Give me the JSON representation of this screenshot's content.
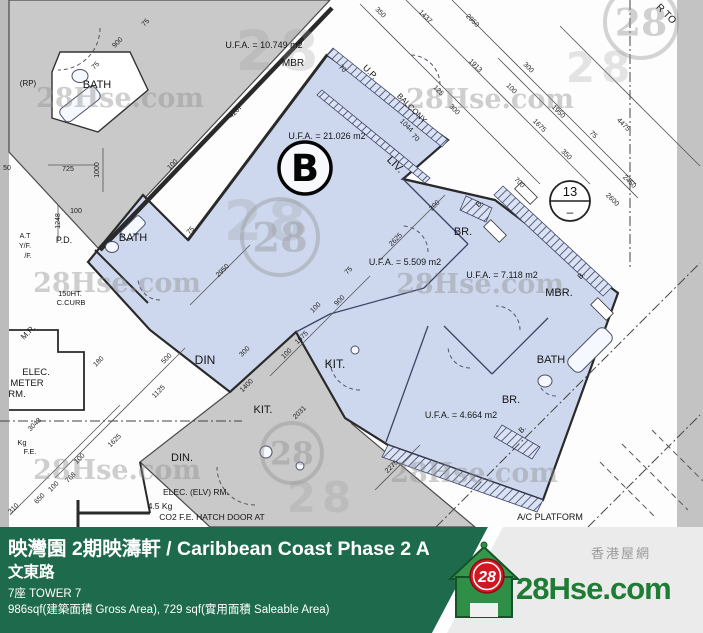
{
  "colors": {
    "footer_green": "#1d6b4c",
    "footer_gray": "#ebebeb",
    "brand_green": "#1e7c35",
    "badge_red": "#d01722",
    "unit_fill": "#cdd8ee",
    "neighbor_fill": "#c9c9c9",
    "edge_strip": "#bcbcbc",
    "line": "#2a2a2a",
    "watermark": "#8f8f8f",
    "plan_bg": "#fdfdfd"
  },
  "plan": {
    "unit_label": "B",
    "grid_bubble": {
      "number": "13",
      "dash": "–"
    },
    "labels": [
      {
        "t": "U.F.A. = 10.749 m2",
        "x": 264,
        "y": 48,
        "s": 9,
        "r": 0
      },
      {
        "t": "MBR",
        "x": 293,
        "y": 66,
        "s": 10,
        "r": 0
      },
      {
        "t": "BATH",
        "x": 97,
        "y": 88,
        "s": 11,
        "r": 0
      },
      {
        "t": "(RP)",
        "x": 28,
        "y": 86,
        "s": 8,
        "r": 0
      },
      {
        "t": "U.P.",
        "x": 368,
        "y": 74,
        "s": 9,
        "r": 45
      },
      {
        "t": "BALCONY",
        "x": 410,
        "y": 110,
        "s": 8,
        "r": 45
      },
      {
        "t": "70",
        "x": 341,
        "y": 70,
        "s": 7,
        "r": 45
      },
      {
        "t": "70",
        "x": 414,
        "y": 139,
        "s": 7,
        "r": 45
      },
      {
        "t": "U.F.A. = 21.026 m2",
        "x": 327,
        "y": 139,
        "s": 9,
        "r": 0
      },
      {
        "t": "LIV.",
        "x": 393,
        "y": 167,
        "s": 11,
        "r": 45
      },
      {
        "t": "BR.",
        "x": 463,
        "y": 235,
        "s": 11,
        "r": 0
      },
      {
        "t": "U.F.A. = 5.509 m2",
        "x": 405,
        "y": 265,
        "s": 9,
        "r": 0
      },
      {
        "t": "U.F.A. = 7.118 m2",
        "x": 502,
        "y": 278,
        "s": 9,
        "r": 0
      },
      {
        "t": "MBR.",
        "x": 559,
        "y": 296,
        "s": 11,
        "r": 0
      },
      {
        "t": "BATH",
        "x": 551,
        "y": 363,
        "s": 11,
        "r": 0
      },
      {
        "t": "BR.",
        "x": 511,
        "y": 403,
        "s": 11,
        "r": 0
      },
      {
        "t": "U.F.A. = 4.664 m2",
        "x": 461,
        "y": 418,
        "s": 9,
        "r": 0
      },
      {
        "t": "B.",
        "x": 481,
        "y": 205,
        "s": 7.5,
        "r": -45
      },
      {
        "t": "B.",
        "x": 583,
        "y": 277,
        "s": 7.5,
        "r": -45
      },
      {
        "t": "B.",
        "x": 524,
        "y": 431,
        "s": 7.5,
        "r": -45
      },
      {
        "t": "BATH",
        "x": 133,
        "y": 241,
        "s": 11,
        "r": 0
      },
      {
        "t": "P.D.",
        "x": 64,
        "y": 243,
        "s": 9,
        "r": 0
      },
      {
        "t": "150HT.",
        "x": 70,
        "y": 296,
        "s": 7.5,
        "r": 0
      },
      {
        "t": "C.CURB",
        "x": 71,
        "y": 305,
        "s": 7.5,
        "r": 0
      },
      {
        "t": "M.R.",
        "x": 30,
        "y": 334,
        "s": 8,
        "r": -45
      },
      {
        "t": "ELEC.",
        "x": 36,
        "y": 375,
        "s": 9.5,
        "r": 0
      },
      {
        "t": "METER",
        "x": 27,
        "y": 386,
        "s": 9.5,
        "r": 0
      },
      {
        "t": "RM.",
        "x": 17,
        "y": 397,
        "s": 9.5,
        "r": 0
      },
      {
        "t": "A.T",
        "x": 25,
        "y": 238,
        "s": 7,
        "r": 0
      },
      {
        "t": "Y/F.",
        "x": 25,
        "y": 248,
        "s": 7,
        "r": 0
      },
      {
        "t": "/F.",
        "x": 28,
        "y": 258,
        "s": 7,
        "r": 0
      },
      {
        "t": "Kg",
        "x": 22,
        "y": 445,
        "s": 7.5,
        "r": 0
      },
      {
        "t": "F.E.",
        "x": 30,
        "y": 454,
        "s": 7.5,
        "r": 0
      },
      {
        "t": "DIN",
        "x": 205,
        "y": 364,
        "s": 12,
        "r": 0
      },
      {
        "t": "KIT.",
        "x": 335,
        "y": 368,
        "s": 12,
        "r": 0
      },
      {
        "t": "KIT.",
        "x": 263,
        "y": 413,
        "s": 11,
        "r": 0
      },
      {
        "t": "DIN.",
        "x": 182,
        "y": 461,
        "s": 11,
        "r": 0
      },
      {
        "t": "ELEC. (ELV) RM.",
        "x": 196,
        "y": 495,
        "s": 8.5,
        "r": 0
      },
      {
        "t": "4.5 Kg",
        "x": 160,
        "y": 509,
        "s": 8.5,
        "r": 0
      },
      {
        "t": "CO2 F.E.  HATCH DOOR AT",
        "x": 212,
        "y": 520,
        "s": 8.5,
        "r": 0
      },
      {
        "t": "A/C PLATFORM",
        "x": 550,
        "y": 520,
        "s": 9,
        "r": 0
      },
      {
        "t": "R TO",
        "x": 664,
        "y": 16,
        "s": 10,
        "r": 45
      }
    ],
    "dimensions": [
      {
        "t": "350",
        "x": 379,
        "y": 14,
        "r": 45
      },
      {
        "t": "1437",
        "x": 424,
        "y": 18,
        "r": 45
      },
      {
        "t": "2950",
        "x": 471,
        "y": 22,
        "r": 45
      },
      {
        "t": "1913",
        "x": 474,
        "y": 67,
        "r": 45
      },
      {
        "t": "300",
        "x": 527,
        "y": 69,
        "r": 45
      },
      {
        "t": "100",
        "x": 510,
        "y": 90,
        "r": 45
      },
      {
        "t": "125",
        "x": 437,
        "y": 92,
        "r": 45
      },
      {
        "t": "300",
        "x": 453,
        "y": 111,
        "r": 45
      },
      {
        "t": "1950",
        "x": 557,
        "y": 113,
        "r": 45
      },
      {
        "t": "1675",
        "x": 538,
        "y": 127,
        "r": 45
      },
      {
        "t": "4475",
        "x": 622,
        "y": 126,
        "r": 45
      },
      {
        "t": "75",
        "x": 592,
        "y": 136,
        "r": 45
      },
      {
        "t": "350",
        "x": 565,
        "y": 156,
        "r": 45
      },
      {
        "t": "2450",
        "x": 628,
        "y": 183,
        "r": 45
      },
      {
        "t": "2600",
        "x": 611,
        "y": 201,
        "r": 45
      },
      {
        "t": "700",
        "x": 518,
        "y": 184,
        "r": 45
      },
      {
        "t": "1044",
        "x": 405,
        "y": 127,
        "r": 45
      },
      {
        "t": "900",
        "x": 119,
        "y": 44,
        "r": -45
      },
      {
        "t": "75",
        "x": 97,
        "y": 67,
        "r": -45
      },
      {
        "t": "75",
        "x": 147,
        "y": 24,
        "r": -45
      },
      {
        "t": "4267",
        "x": 237,
        "y": 113,
        "r": -45
      },
      {
        "t": "100",
        "x": 174,
        "y": 166,
        "r": -45
      },
      {
        "t": "725",
        "x": 68,
        "y": 171,
        "r": 0
      },
      {
        "t": "1000",
        "x": 99,
        "y": 170,
        "r": -90
      },
      {
        "t": "50",
        "x": 7,
        "y": 170,
        "r": 0
      },
      {
        "t": "1248",
        "x": 60,
        "y": 221,
        "r": -90
      },
      {
        "t": "100",
        "x": 76,
        "y": 213,
        "r": 0
      },
      {
        "t": "2950",
        "x": 224,
        "y": 272,
        "r": -45
      },
      {
        "t": "75",
        "x": 192,
        "y": 232,
        "r": -45
      },
      {
        "t": "2625",
        "x": 397,
        "y": 241,
        "r": -45
      },
      {
        "t": "200",
        "x": 436,
        "y": 207,
        "r": -45
      },
      {
        "t": "75",
        "x": 350,
        "y": 272,
        "r": -45
      },
      {
        "t": "900",
        "x": 341,
        "y": 302,
        "r": -45
      },
      {
        "t": "100",
        "x": 317,
        "y": 309,
        "r": -45
      },
      {
        "t": "1675",
        "x": 303,
        "y": 339,
        "r": -45
      },
      {
        "t": "100",
        "x": 288,
        "y": 355,
        "r": -45
      },
      {
        "t": "300",
        "x": 246,
        "y": 353,
        "r": -45
      },
      {
        "t": "500",
        "x": 168,
        "y": 360,
        "r": -45
      },
      {
        "t": "1125",
        "x": 160,
        "y": 393,
        "r": -45
      },
      {
        "t": "180",
        "x": 100,
        "y": 363,
        "r": -45
      },
      {
        "t": "3043",
        "x": 36,
        "y": 426,
        "r": -45
      },
      {
        "t": "1625",
        "x": 116,
        "y": 442,
        "r": -45
      },
      {
        "t": "100",
        "x": 81,
        "y": 460,
        "r": -45
      },
      {
        "t": "768",
        "x": 72,
        "y": 479,
        "r": -45
      },
      {
        "t": "100",
        "x": 55,
        "y": 488,
        "r": -45
      },
      {
        "t": "650",
        "x": 41,
        "y": 500,
        "r": -45
      },
      {
        "t": "310",
        "x": 15,
        "y": 510,
        "r": -45
      },
      {
        "t": "1400",
        "x": 248,
        "y": 387,
        "r": -45
      },
      {
        "t": "2031",
        "x": 301,
        "y": 414,
        "r": -45
      },
      {
        "t": "2275",
        "x": 393,
        "y": 468,
        "r": -45
      }
    ],
    "watermarks": [
      {
        "type": "text",
        "t": "28Hse.com",
        "x": 120,
        "y": 107,
        "s": 27
      },
      {
        "type": "text",
        "t": "28Hse.com",
        "x": 490,
        "y": 108,
        "s": 27
      },
      {
        "type": "text",
        "t": "28Hse.com",
        "x": 117,
        "y": 292,
        "s": 27
      },
      {
        "type": "text",
        "t": "28Hse.com",
        "x": 480,
        "y": 293,
        "s": 27
      },
      {
        "type": "text",
        "t": "28Hse.com",
        "x": 117,
        "y": 479,
        "s": 27
      },
      {
        "type": "text",
        "t": "28Hse.com",
        "x": 474,
        "y": 482,
        "s": 27
      },
      {
        "type": "ring",
        "t": "28",
        "x": 280,
        "y": 237,
        "s": 38
      },
      {
        "type": "ring",
        "t": "28",
        "x": 292,
        "y": 453,
        "s": 30
      },
      {
        "type": "ring",
        "t": "28",
        "x": 641,
        "y": 22,
        "s": 36
      },
      {
        "type": "block",
        "t": "28",
        "x": 280,
        "y": 70,
        "s": 55
      },
      {
        "type": "block",
        "t": "28",
        "x": 268,
        "y": 240,
        "s": 55
      },
      {
        "type": "block",
        "t": "28",
        "x": 601,
        "y": 82,
        "s": 42
      },
      {
        "type": "block",
        "t": "28",
        "x": 322,
        "y": 512,
        "s": 42
      }
    ]
  },
  "footer": {
    "title": "映灣園 2期映濤軒 / Caribbean Coast Phase 2 Al",
    "street": "文東路",
    "tower": "7座   TOWER 7",
    "area": "986sqf(建築面積 Gross Area), 729 sqf(實用面積 Saleable Area)",
    "brand": {
      "name": "28Hse.com",
      "badge": "28",
      "tagline": "香港屋網"
    }
  }
}
